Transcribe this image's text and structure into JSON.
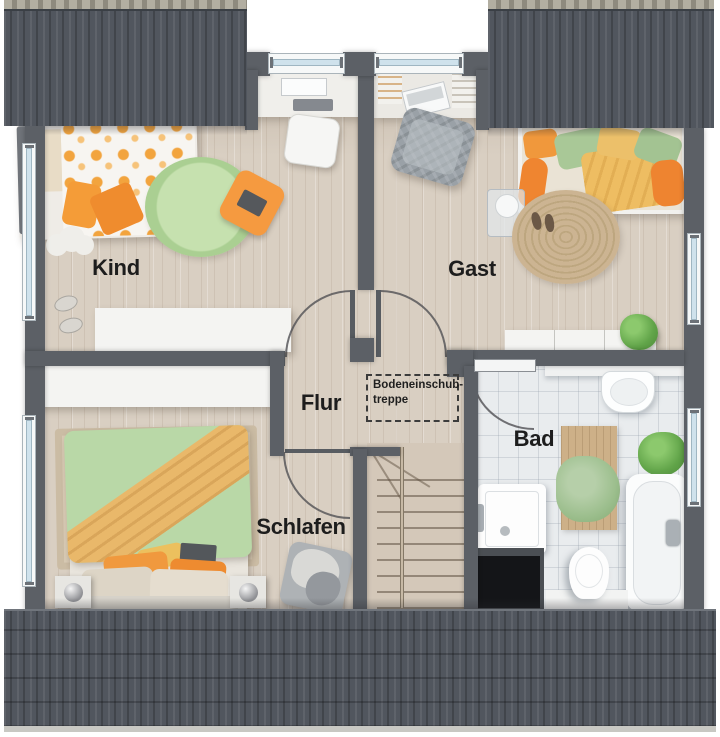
{
  "plan": {
    "rooms": [
      {
        "id": "kind",
        "label": "Kind"
      },
      {
        "id": "gast",
        "label": "Gast"
      },
      {
        "id": "flur",
        "label": "Flur"
      },
      {
        "id": "schlafen",
        "label": "Schlafen"
      },
      {
        "id": "bad",
        "label": "Bad"
      }
    ],
    "note": {
      "line1": "Bodeneinschub-",
      "line2": "treppe"
    },
    "colors": {
      "roof": "#51565e",
      "wall": "#5c6066",
      "wood_floor": "#d9cfc2",
      "tile_floor": "#e9ecee",
      "window_glass": "#cfe2ec",
      "accent_orange": "#f0993e",
      "accent_green": "#b7d8a5",
      "label_text": "#1d1d1d"
    }
  }
}
